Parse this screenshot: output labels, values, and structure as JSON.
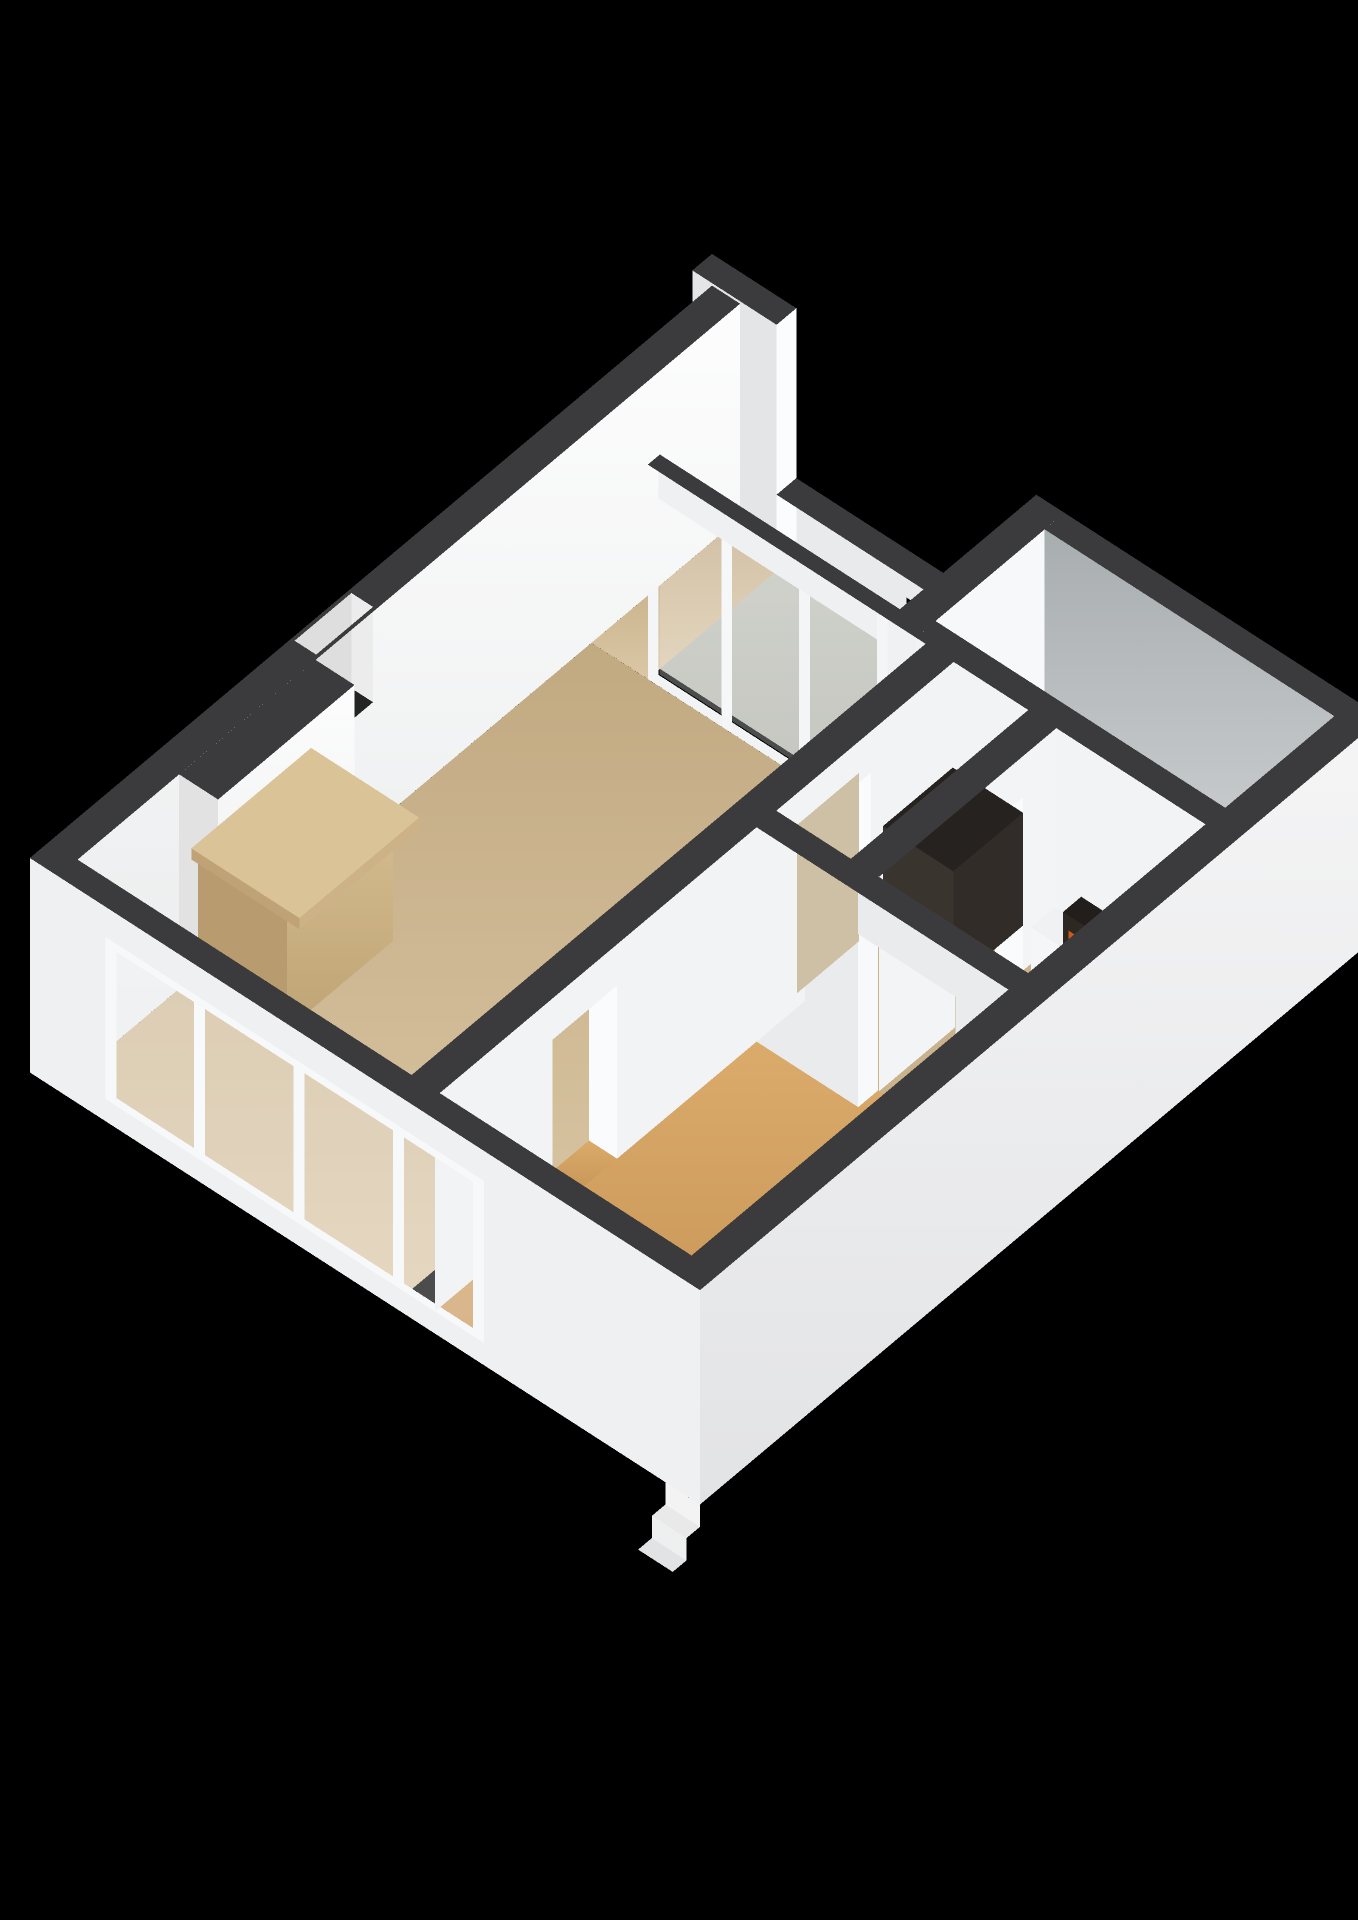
{
  "title": "3D floor plan render",
  "background": "#000000",
  "colors": {
    "wallTop": "#3b3b3d",
    "wallWhite": "#f7f8f9",
    "wallShadowGray": "#b9bec1",
    "exteriorWall": "#eef0f1",
    "floorLiving": "#cdb795",
    "floorHall": "#c9b28c",
    "floorBalcony": "#b4b7ac",
    "floorBathroom": "#c4ced8",
    "floorWood": "#d2a164",
    "glassGreen": "#b5bcb1",
    "glassClear": "rgba(252,253,255,0.30)",
    "doorTan": "#cdc0a5",
    "mantelTan": "#c9b183",
    "fireboxBlack": "#17120d",
    "fireOrange": "#ff8a24",
    "cabinetDark": "#2e2925",
    "tubWhite": "#f4f6f7",
    "railingWhite": "#e8eaec",
    "stepWhite": "#f3f3f4",
    "nicheDark": "#242424"
  },
  "rooms": [
    {
      "id": "living-room",
      "floor": "tan"
    },
    {
      "id": "balcony",
      "floor": "gray"
    },
    {
      "id": "bathroom",
      "floor": "light-blue"
    },
    {
      "id": "hallway",
      "floor": "tan"
    },
    {
      "id": "utility-room",
      "floor": "tan"
    },
    {
      "id": "bedroom",
      "floor": "wood"
    }
  ],
  "fixtures": [
    {
      "id": "fireplace",
      "detail": "tan mantel with burning firebox"
    },
    {
      "id": "chimney-recess",
      "detail": "open cavity in NW wall top"
    },
    {
      "id": "balcony-railing",
      "detail": "half wall with rectangular slots"
    },
    {
      "id": "glass-partition",
      "detail": "floor to ceiling glazing to balcony"
    },
    {
      "id": "ne-window",
      "detail": "window in shadowed NE wall"
    },
    {
      "id": "ne-door",
      "detail": "white entry door with handle"
    },
    {
      "id": "bathtub",
      "detail": "white tub in bathroom"
    },
    {
      "id": "dark-cabinet",
      "detail": "tall dark unit in hallway"
    },
    {
      "id": "boiler-unit",
      "detail": "white ledge with dark slatted unit and orange valves"
    },
    {
      "id": "interior-door",
      "detail": "tan wood door leaf"
    },
    {
      "id": "window-bank",
      "detail": "large 4-pane window wall on SW facade"
    },
    {
      "id": "exterior-steps",
      "detail": "small steps at south corner"
    }
  ]
}
